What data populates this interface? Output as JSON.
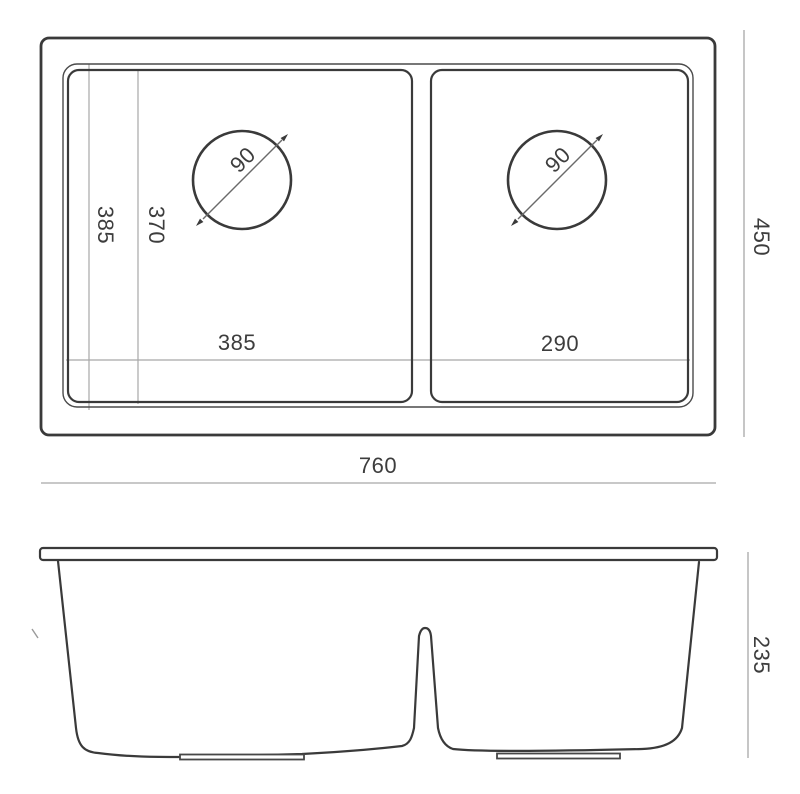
{
  "drawing": {
    "type": "technical-drawing",
    "subject": "double-bowl-undermount-sink",
    "views": [
      "top-view",
      "side-view"
    ],
    "colors": {
      "outline": "#3a3a3a",
      "dimension_line": "#a8a8a8",
      "text": "#3d3d3d",
      "background": "#ffffff"
    },
    "top_view": {
      "overall_width": "760",
      "overall_depth": "450",
      "left_bowl_width": "385",
      "right_bowl_width": "290",
      "rim_opening_depth": "385",
      "bowl_inner_depth": "370",
      "left_drain_diameter": "90",
      "right_drain_diameter": "90"
    },
    "side_view": {
      "overall_height": "235"
    }
  }
}
